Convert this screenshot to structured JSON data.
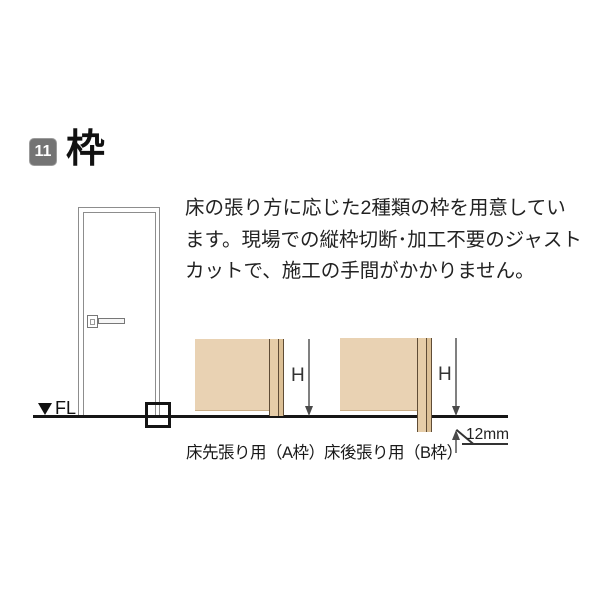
{
  "header": {
    "number": "11",
    "title": "枠"
  },
  "intro": {
    "lines": [
      "床の張り方に応じた2種類の枠を用意してい",
      "ます。現場での縦枠切断･加工不要のジャスト",
      "カットで、施工の手間がかかりません。"
    ]
  },
  "figure": {
    "floor_level_label": "FL",
    "diagram_a": {
      "caption": "床先張り用（A枠）",
      "height_dimension": "H"
    },
    "diagram_b": {
      "caption": "床後張り用（B枠）",
      "height_dimension": "H",
      "protrusion_dimension": "12mm"
    }
  },
  "colors": {
    "badge_gray": "#747474",
    "wall_fill": "#e9d2b3",
    "frame_fill": "#dcc096",
    "frame_outline": "#5f4c36",
    "floor_line": "#161616"
  }
}
